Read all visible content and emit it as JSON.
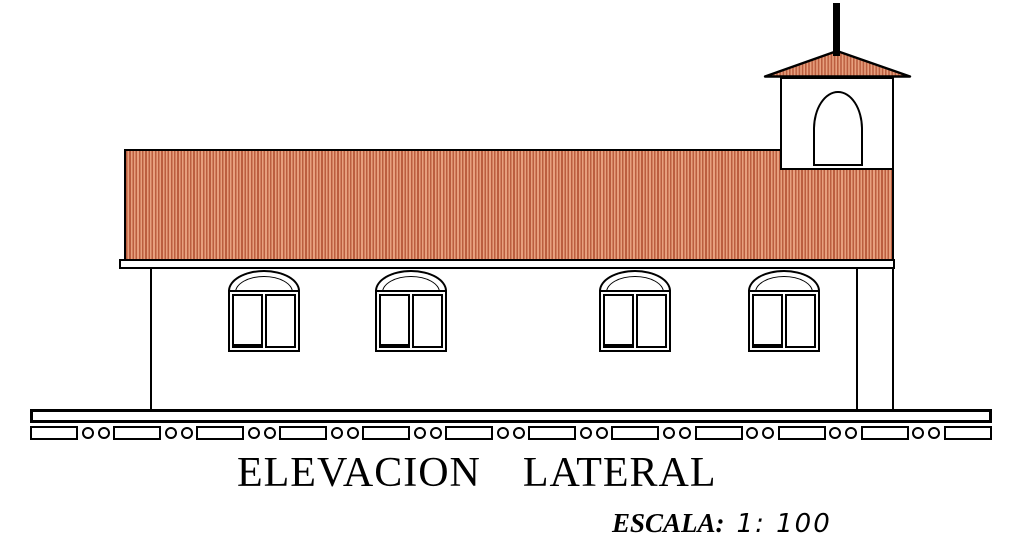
{
  "drawing": {
    "title_word1": "ELEVACION",
    "title_word2": "LATERAL",
    "scale_label": "ESCALA:",
    "scale_value": "1: 100",
    "windows_count": 4,
    "colors": {
      "line": "#000000",
      "background": "#ffffff",
      "wall_fill": "#ffffff",
      "roof_stripe_dark": "#bb5e3f",
      "roof_stripe_light": "#e7a07e"
    }
  },
  "ground": {
    "blocks": 12,
    "rings_per_gap": 2
  }
}
